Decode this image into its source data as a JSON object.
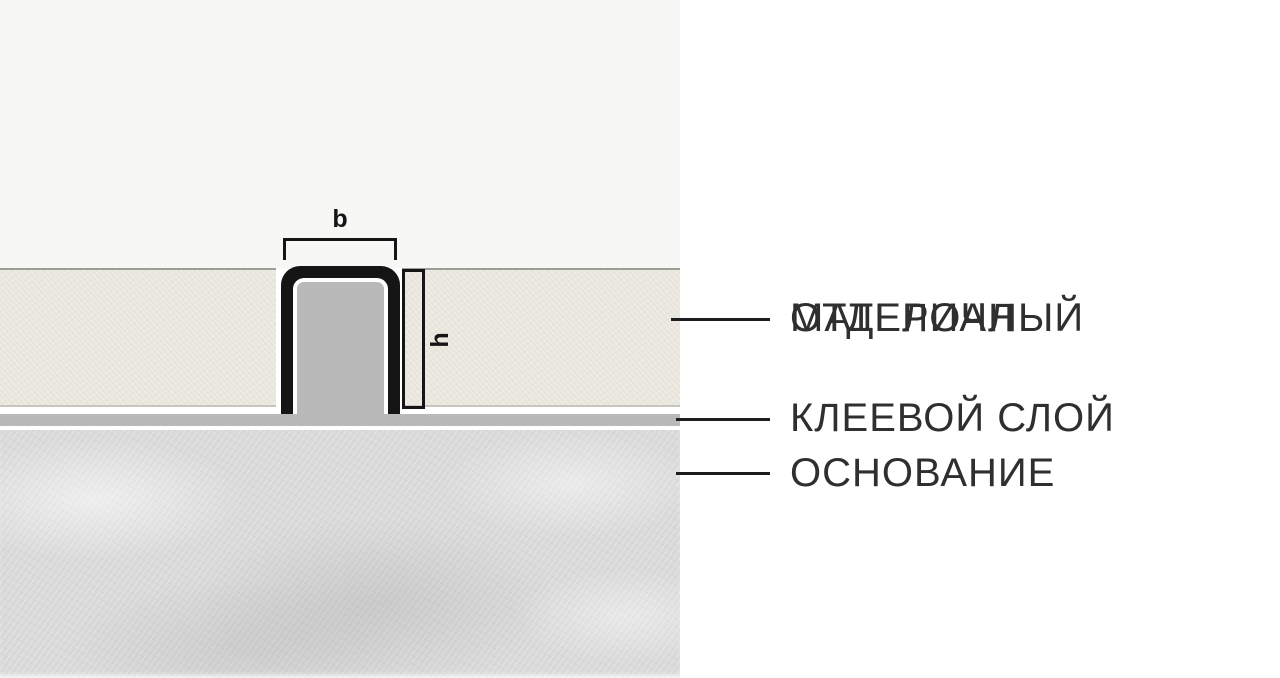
{
  "diagram": {
    "dim_width_label": "b",
    "dim_height_label": "h"
  },
  "legend": {
    "finishing_material": {
      "line1": "ОТДЕЛОЧНЫЙ",
      "line2": "МАТЕРИАЛ"
    },
    "adhesive_layer": {
      "line1": "КЛЕЕВОЙ СЛОЙ"
    },
    "substrate": {
      "line1": "ОСНОВАНИЕ"
    }
  },
  "colors": {
    "finishing_material": "#e9e7dd",
    "adhesive_layer": "#b9b9b9",
    "substrate": "#d9d9d9",
    "profile_outline": "#151515",
    "profile_core": "#b9b9b9",
    "leader_line": "#1d1d1d",
    "label_text": "#2f2f2f",
    "canvas_top_background": "#f7f7f5",
    "panel_background": "#ffffff"
  }
}
